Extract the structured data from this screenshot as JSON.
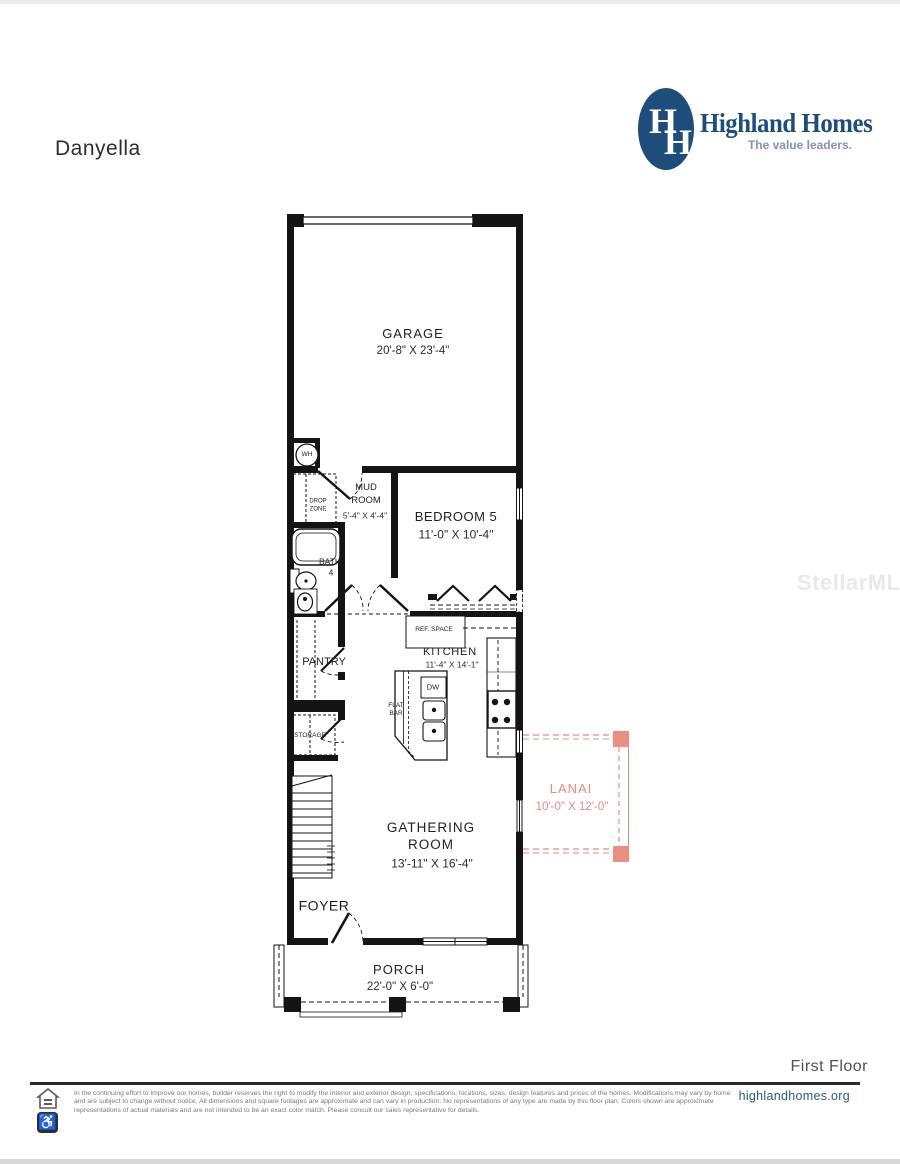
{
  "header": {
    "plan_name": "Danyella"
  },
  "logo": {
    "monogram_h1": "H",
    "monogram_h2": "H",
    "brand": "Highland Homes",
    "tagline": "The value leaders.",
    "navy": "#1E4D7C",
    "tagline_color": "#8494AB"
  },
  "watermark": {
    "text": "StellarMLS"
  },
  "rooms": {
    "garage": {
      "name": "GARAGE",
      "dims": "20'-8\" X 23'-4\""
    },
    "wh": {
      "name": "WH"
    },
    "mud_room": {
      "name": "MUD ROOM",
      "dims": "5'-4\" X 4'-4\""
    },
    "drop_zone": {
      "name": "DROP ZONE"
    },
    "bedroom5": {
      "name": "BEDROOM 5",
      "dims": "11'-0\" X 10'-4\""
    },
    "bath": {
      "name": "BATH",
      "number": "4"
    },
    "ref_space": {
      "name": "REF. SPACE"
    },
    "kitchen": {
      "name": "KITCHEN",
      "dims": "11'-4\" X 14'-1\""
    },
    "pantry": {
      "name": "PANTRY"
    },
    "dw": {
      "name": "DW"
    },
    "flat_bar": {
      "name": "FLAT BAR"
    },
    "storage": {
      "name": "STORAGE"
    },
    "gathering_room": {
      "name": "GATHERING ROOM",
      "dims": "13'-11\" X 16'-4\""
    },
    "foyer": {
      "name": "FOYER"
    },
    "porch": {
      "name": "PORCH",
      "dims": "22'-0\" X 6'-0\""
    },
    "lanai": {
      "name": "LANAI",
      "dims": "10'-0\" X 12'-0\"",
      "color": "#E8897E"
    }
  },
  "footer": {
    "floor_label": "First Floor",
    "website": "highlandhomes.org",
    "disclaimer": "In the continuing effort to improve our homes, builder reserves the right to modify the interior and exterior design, specifications, locations, sizes, design features and prices of the homes. Modifications may vary by home and are subject to change without notice. All dimensions and square footages are approximate and can vary in production. No representations of any type are made by this floor plan. Colors shown are approximate representations of actual materials and are not intended to be an exact color match. Please consult our sales representative for details."
  },
  "colors": {
    "wall": "#141414",
    "lanai_salmon": "#E8897E",
    "website_blue": "#2F5A77"
  }
}
